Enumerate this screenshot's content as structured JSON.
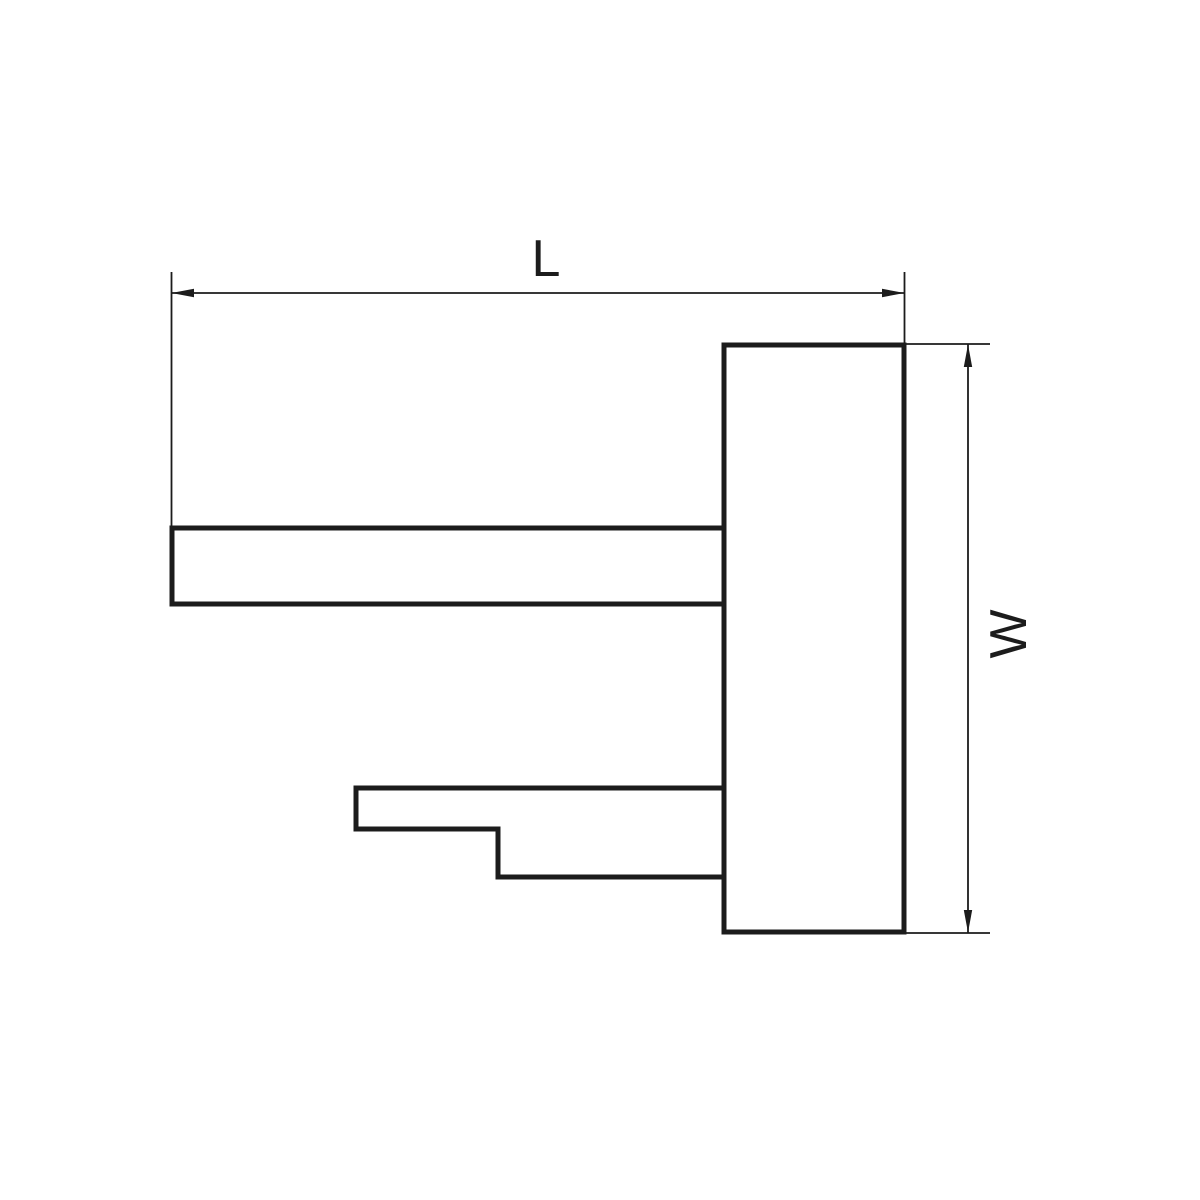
{
  "drawing": {
    "background_color": "#ffffff",
    "line_color": "#1c1c1c",
    "labels": {
      "length": "L",
      "width": "W"
    }
  }
}
